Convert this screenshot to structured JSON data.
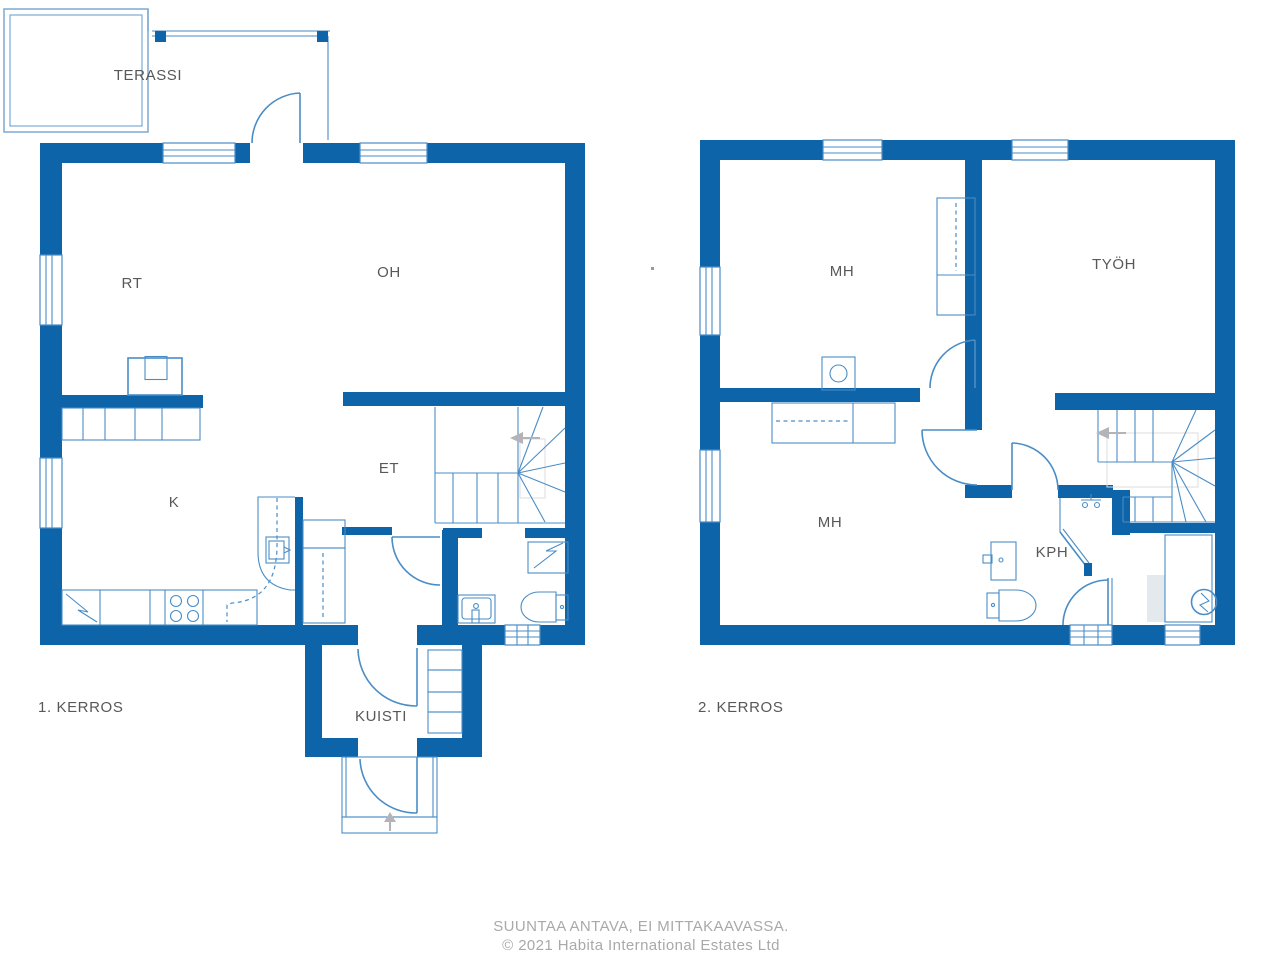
{
  "colors": {
    "wall": "#0e64a8",
    "fixture": "#4a8dc6",
    "terrace": "#85afd4",
    "label": "#57585a",
    "footer": "#a9a9a9",
    "arrow": "#b4b4b8"
  },
  "floor1": {
    "label": "1. KERROS",
    "rooms": {
      "terassi": "TERASSI",
      "rt": "RT",
      "oh": "OH",
      "k": "K",
      "et": "ET",
      "kuisti": "KUISTI"
    }
  },
  "floor2": {
    "label": "2. KERROS",
    "rooms": {
      "mh_upper": "MH",
      "tyoh": "TYÖH",
      "mh_lower": "MH",
      "kph": "KPH"
    }
  },
  "footer": {
    "line1": "SUUNTAA ANTAVA, EI MITTAKAAVASSA.",
    "line2": "© 2021 Habita International Estates Ltd"
  }
}
